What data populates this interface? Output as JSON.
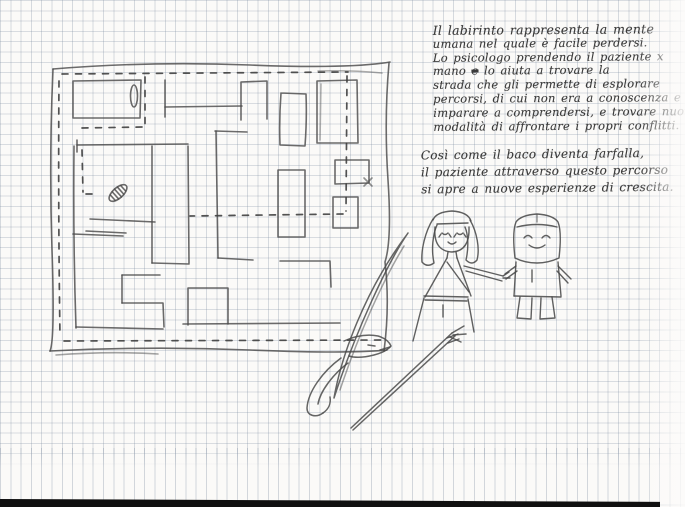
{
  "document": {
    "kind_visible": "hand-drawn notebook page",
    "handwriting": {
      "para1_lines_a": [
        "Il labirinto rappresenta la mente",
        "umana nel quale è facile perdersi.",
        "Lo psicologo prendendo il paziente x"
      ],
      "line4_pre": "mano ",
      "line4_struck": "e",
      "line4_post": " lo aiuta a trovare la",
      "para1_lines_b": [
        "strada che gli permette di esplorare",
        "percorsi, di cui non era a conoscenza e",
        "imparare a comprendersi, e trovare nuove",
        "modalità di affrontare i propri conflitti."
      ],
      "para2_lines": [
        "Così come il baco diventa farfalla,",
        "il paziente attraverso questo percorso",
        "si apre a nuove esperienze di crescita."
      ]
    }
  },
  "colors": {
    "paper": "#fbfaf8",
    "grid_line": "#aab4c2",
    "pencil": "#4a4a4a",
    "ink_text": "#3a3a3a",
    "photo_edge": "#101010"
  }
}
